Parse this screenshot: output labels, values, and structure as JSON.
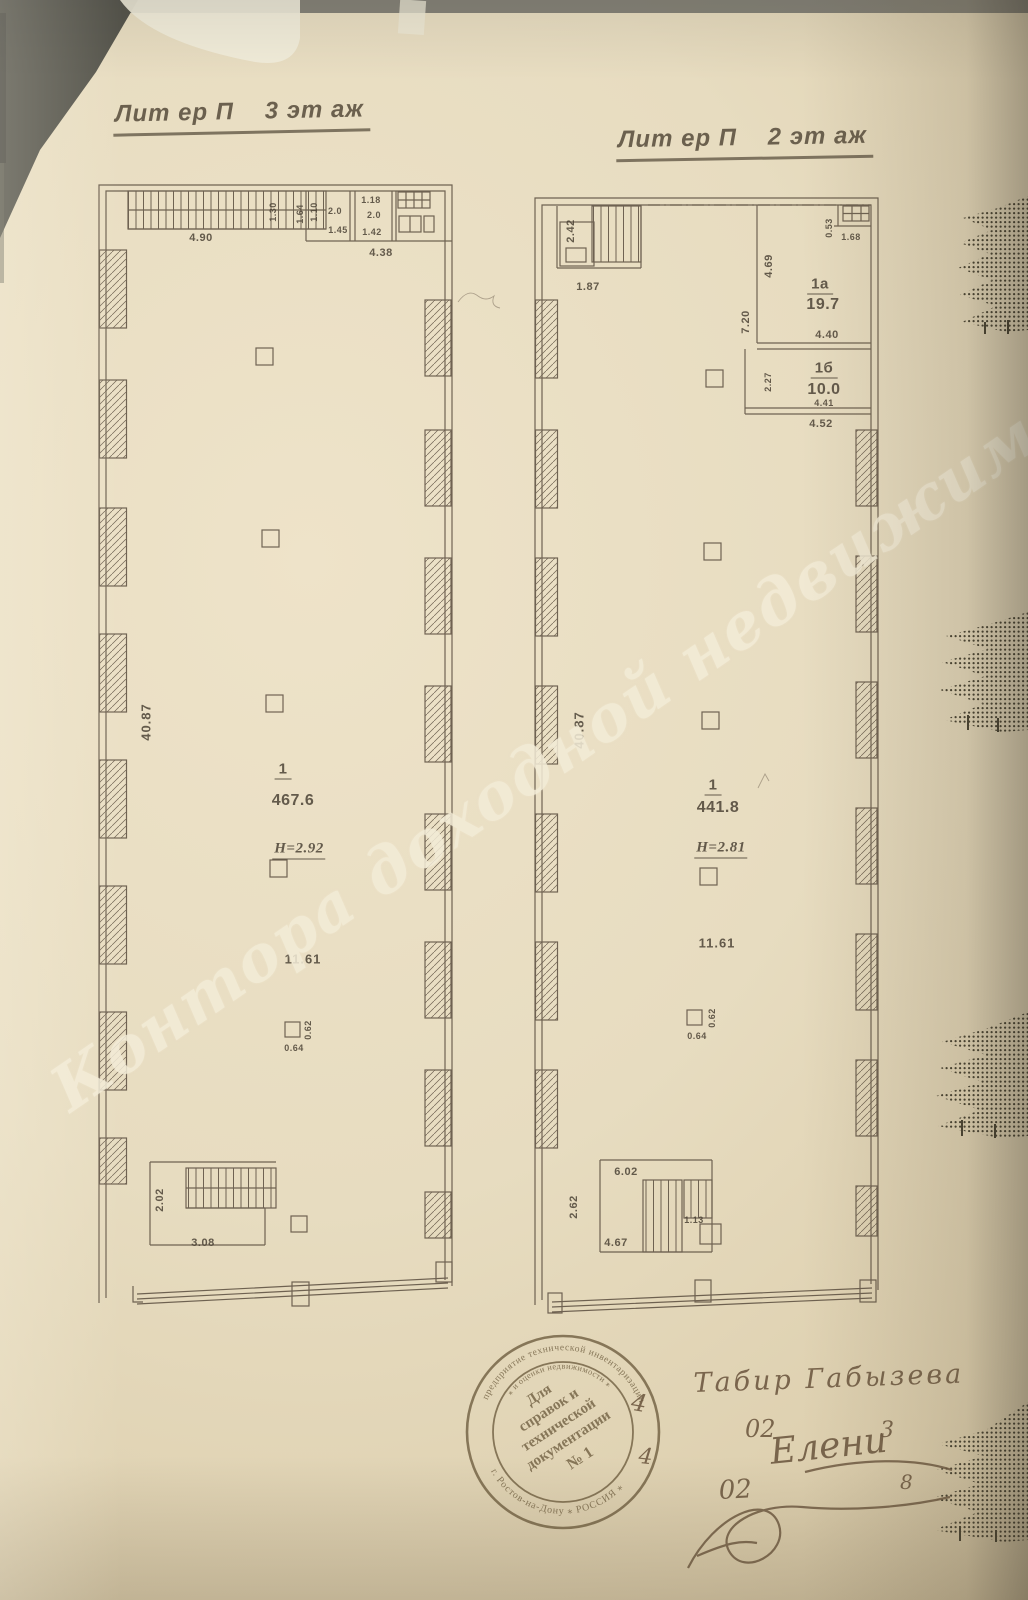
{
  "colors": {
    "paper": "#e8ddc2",
    "ink": "#55483a",
    "stamp_ink": "#6d5c3e",
    "pencil": "#6f5a42",
    "watermark": "#f3ecd7"
  },
  "titles": {
    "plan3": "Лит ер П    3 эт аж",
    "plan2": "Лит ер П    2 эт аж"
  },
  "watermark": {
    "text": "Контора доходной недвижимости"
  },
  "plan3": {
    "room1": {
      "number": "1",
      "area": "467.6",
      "ceiling": "Н=2.92",
      "span": "11.61",
      "length": "40.87"
    },
    "dims": {
      "top_width": "4.90",
      "d_130": "1.30",
      "d_164": "1.64",
      "d_110": "1.10",
      "d_20a": "2.0",
      "d_145": "1.45",
      "d_118": "1.18",
      "d_20b": "2.0",
      "d_142": "1.42",
      "d_438": "4.38",
      "col_w": "0.62",
      "col_d": "0.64",
      "stair_h": "2.02",
      "stair_w": "3.08"
    }
  },
  "plan2": {
    "room1": {
      "number": "1",
      "area": "441.8",
      "ceiling": "Н=2.81",
      "span": "11.61",
      "length": "40.87"
    },
    "room1a": {
      "number": "1а",
      "area": "19.7",
      "d_469": "4.69",
      "d_720": "7.20",
      "d_440": "4.40",
      "d_053": "0.53",
      "d_168": "1.68"
    },
    "room1b": {
      "number": "1б",
      "area": "10.0",
      "d_227": "2.27",
      "d_441": "4.41",
      "d_452": "4.52"
    },
    "dims": {
      "stair_top_h": "2.42",
      "stair_top_w": "1.87",
      "col_w": "0.62",
      "col_d": "0.64",
      "stair_bot_w": "6.02",
      "stair_bot_h": "2.62",
      "d_467": "4.67",
      "d_113": "1.13"
    }
  },
  "stamp": {
    "inner_line1": "Для",
    "inner_line2": "справок и",
    "inner_line3": "технической",
    "inner_line4": "документации",
    "inner_line5": "№ 1",
    "arc_top": "предприятие технической инвентаризации",
    "arc_mid": "⁎ и оценки недвижимости ⁎",
    "arc_bottom": "г. Ростов-на-Дону ⁎ РОССИЯ ⁎"
  },
  "handwriting": {
    "line1": "Табир Габызева",
    "n1": "02",
    "n2": "3",
    "line2": "Елени",
    "n3": "02",
    "n4": "8",
    "m1": "4",
    "m2": "4"
  }
}
